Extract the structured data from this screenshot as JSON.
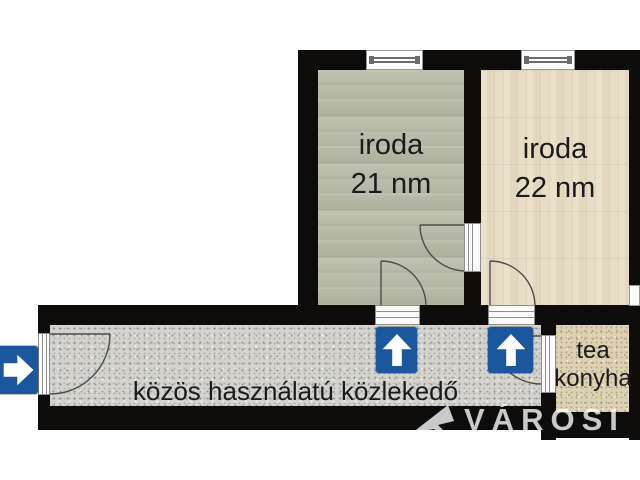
{
  "rooms": {
    "office_left": {
      "label": "iroda",
      "area": "21 nm"
    },
    "office_right": {
      "label": "iroda",
      "area": "22 nm"
    },
    "corridor": {
      "label": "közös használatú közlekedő"
    },
    "tea_kitchen": {
      "label_line1": "tea",
      "label_line2": "konyha"
    }
  },
  "markers": {
    "entrance_arrow_icon": "right-arrow",
    "office_left_door_arrow_icon": "up-arrow",
    "office_right_door_arrow_icon": "up-arrow"
  },
  "watermark": {
    "text": "VÁROSI"
  },
  "colors": {
    "wall_black": "#0d0c0a",
    "sign_blue": "#1b579c",
    "corridor_floor_gray": "#d4d3ce",
    "office_left_floor": "#b8bba9",
    "office_right_floor": "#e3d7bf",
    "tea_floor_tan": "#ddd1b4"
  }
}
